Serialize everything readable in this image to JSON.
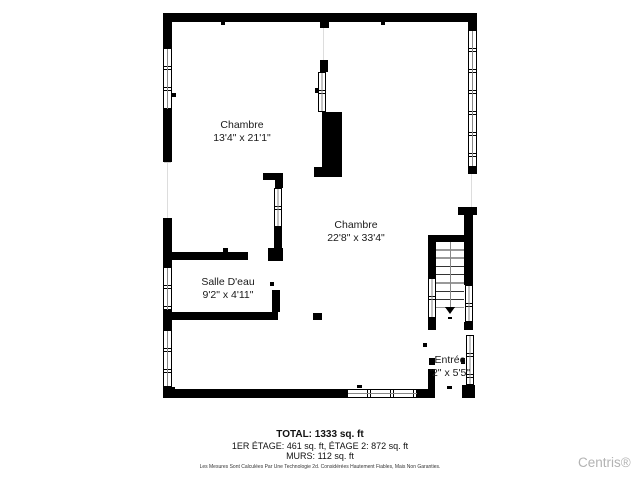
{
  "plan": {
    "rooms": [
      {
        "name": "Chambre",
        "dims": "13'4\" x 21'1\""
      },
      {
        "name": "Chambre",
        "dims": "22'8\" x 33'4\""
      },
      {
        "name": "Salle D'eau",
        "dims": "9'2\" x 4'11\""
      },
      {
        "name": "Entrée",
        "dims": "'2\" x 5'5\""
      }
    ]
  },
  "footer": {
    "total": "TOTAL: 1333 sq. ft",
    "floors": "1ER ÉTAGE: 461 sq. ft, ÉTAGE 2: 872 sq. ft",
    "walls": "MURS: 112 sq. ft",
    "disclaimer": "Les Mesures Sont Calculées Par Une Technologie 2d. Considérées Hautement Fiables, Mais Non Garanties."
  },
  "branding": {
    "watermark": "Centris®"
  },
  "colors": {
    "wall": "#000000",
    "background": "#ffffff",
    "watermark": "#b3b3b3",
    "stair_tread": "#333333"
  }
}
